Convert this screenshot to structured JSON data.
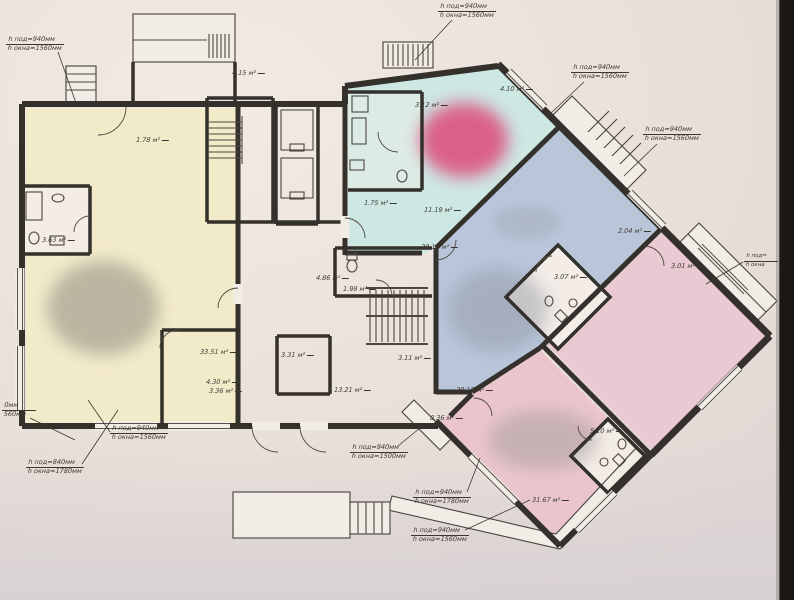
{
  "plan": {
    "description_labels_language": "ru",
    "callouts": [
      {
        "line1": "h под=940мм",
        "line2": "h окна=1560мм"
      },
      {
        "line1": "h под=940мм",
        "line2": "h окна=1560мм"
      },
      {
        "line1": "h под=940мм",
        "line2": "h окна=1560мм"
      },
      {
        "line1": "h под=940мм",
        "line2": "h окна=1560мм"
      },
      {
        "line1": "0мм",
        "line2": "560мм"
      },
      {
        "line1": "h под=940мм",
        "line2": "h окна=1560мм"
      },
      {
        "line1": "h под=840мм",
        "line2": "h окна=1780мм"
      },
      {
        "line1": "h под=940мм",
        "line2": "h окна=1500мм"
      },
      {
        "line1": "h под=940мм",
        "line2": "h окна=1780мм"
      },
      {
        "line1": "h под=940мм",
        "line2": "h окна=1560мм"
      },
      {
        "line1": "h под=",
        "line2": "h окна"
      }
    ],
    "areas": {
      "yellow_bath": "3.63 м²",
      "yellow_top_door": "1.78 м²",
      "entry_top": "4.15 м²",
      "yellow_room": "33.51 м²",
      "yellow_small_a": "4.30 м²",
      "yellow_small_b": "3.36 м²",
      "core_store": "3.31 м²",
      "corridor": "13.21 м²",
      "core_right": "3.11 м²",
      "wc_a": "4.86 м²",
      "wc_b": "1.98 м²",
      "teal_bath_a": "3.12 м²",
      "teal_bath_b": "1.75 м²",
      "teal_top": "4.10 м²",
      "hall_a": "11.19 м²",
      "hall_b": "20.14 м²",
      "blue_door": "2.04 м²",
      "pink2_hall": "3.01 м²",
      "wing_bath": "3.07 м²",
      "blue_bottom": "20.16 м²",
      "wing_left": "8.36 м²",
      "pink_room": "31.67 м²",
      "pink_bath": "5.10 м²"
    }
  },
  "colors": {
    "paper": "#eae0da",
    "paper-light": "#f3eae3",
    "paper-low": "#d9d3d5",
    "wall": "#34302b",
    "thin": "#4c463f",
    "room-yellow": "#f2ebc9",
    "room-teal": "#cde7e2",
    "room-blue": "#b9c6da",
    "room-pink": "#eac6cc",
    "room-pink2": "#e9c9d2",
    "blob-red": "#dd4a7c",
    "blob-gray": "#a1988c",
    "blob-slate": "#8e94a2",
    "photo-edge": "#1a1715"
  }
}
